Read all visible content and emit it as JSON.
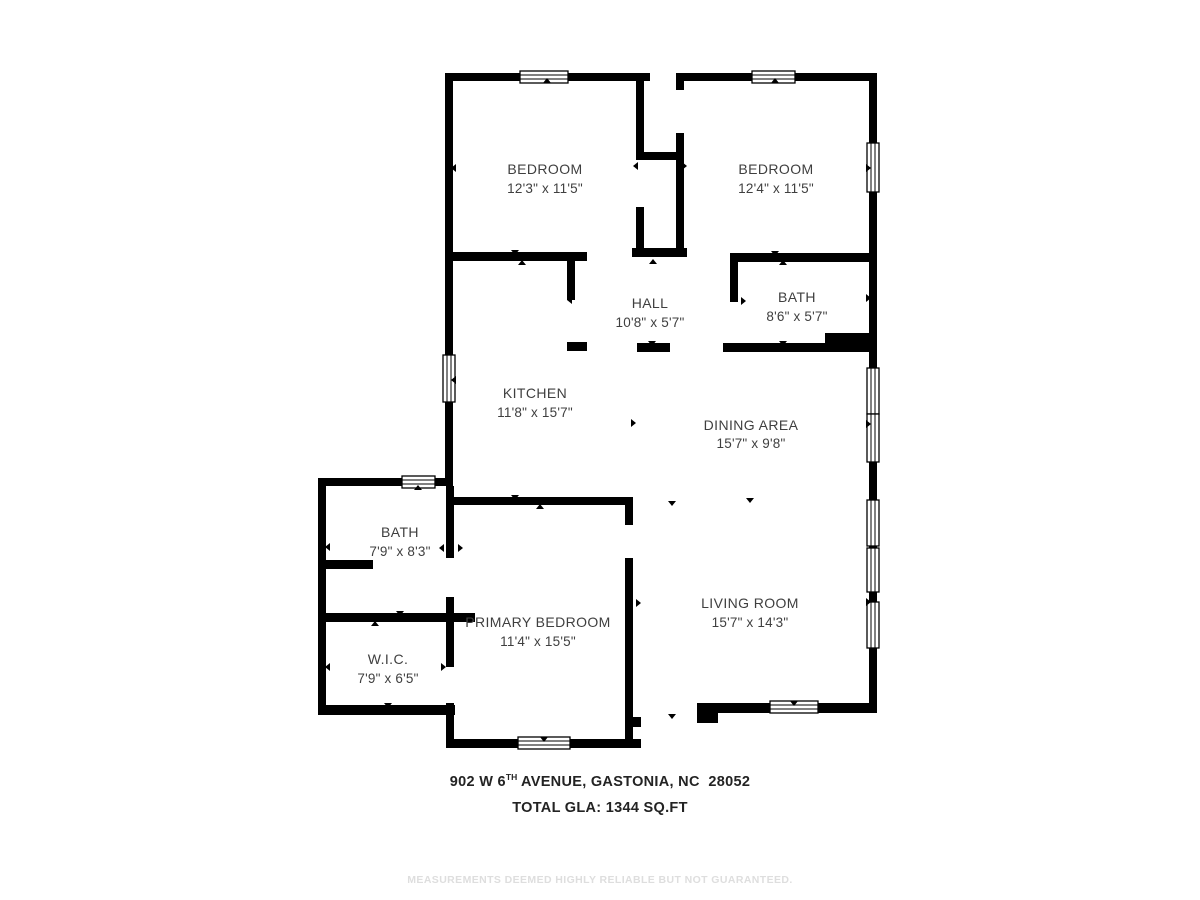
{
  "plan": {
    "rooms": [
      {
        "name": "BEDROOM",
        "dims": "12'3\" x 11'5\""
      },
      {
        "name": "BEDROOM",
        "dims": "12'4\" x 11'5\""
      },
      {
        "name": "HALL",
        "dims": "10'8\" x 5'7\""
      },
      {
        "name": "BATH",
        "dims": "8'6\" x 5'7\""
      },
      {
        "name": "KITCHEN",
        "dims": "11'8\" x 15'7\""
      },
      {
        "name": "DINING AREA",
        "dims": "15'7\" x 9'8\""
      },
      {
        "name": "BATH",
        "dims": "7'9\" x 8'3\""
      },
      {
        "name": "W.I.C.",
        "dims": "7'9\" x 6'5\""
      },
      {
        "name": "PRIMARY BEDROOM",
        "dims": "11'4\" x 15'5\""
      },
      {
        "name": "LIVING ROOM",
        "dims": "15'7\" x 14'3\""
      }
    ],
    "footer": {
      "address_prefix": "902 W 6",
      "address_sup": "TH",
      "address_rest": " AVENUE, GASTONIA, NC  28052",
      "total_gla": "TOTAL GLA: 1344 SQ.FT",
      "disclaimer": "MEASUREMENTS DEEMED HIGHLY RELIABLE BUT NOT GUARANTEED."
    },
    "colors": {
      "wall": "#000000",
      "room_text": "#3f3f3f",
      "address_text": "#232323",
      "disclaimer_text": "#dedede"
    }
  }
}
